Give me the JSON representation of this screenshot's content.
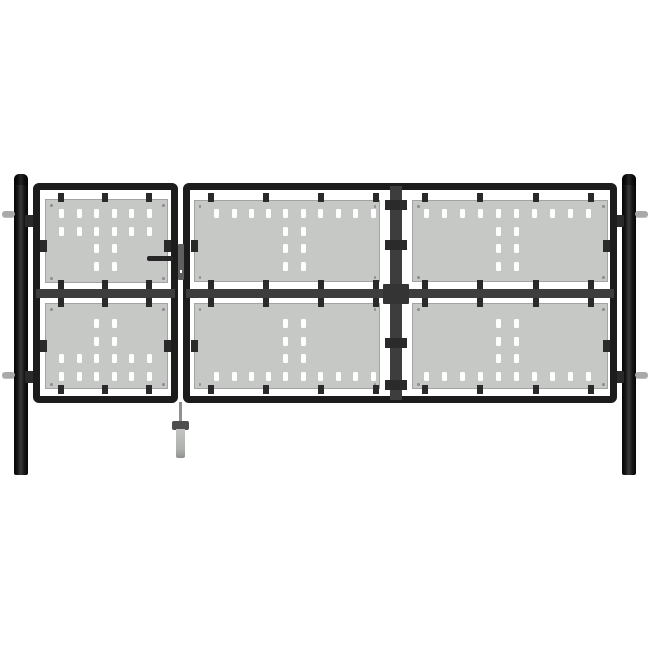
{
  "scene": {
    "type": "product-image",
    "subject": "black steel single-and-double garden gate with grey perforated panels, two round posts, handle and drop bolt",
    "background": "#ffffff"
  },
  "colors": {
    "bg": "#ffffff",
    "frame": "#1c1c1c",
    "rail": "#3d3d3d",
    "panel": "#c6c8c6",
    "slot": "#ffffff",
    "clamp": "#2a2a2a",
    "hinge": "#a7aaa7",
    "lock": "#5f5f5f",
    "handle": "#262626",
    "boltcap": "#4e4e4e"
  },
  "gate": {
    "panels": [
      {
        "id": "pedestrian-top-panel",
        "x": 45,
        "y": 199,
        "w": 123,
        "h": 84,
        "rows": [
          {
            "y": 212.5,
            "xs": [
              60.5,
              78,
              95.5,
              113,
              130.5,
              148
            ]
          },
          {
            "y": 230,
            "xs": [
              60.5,
              78,
              95.5,
              113,
              130.5,
              148
            ]
          },
          {
            "y": 247.5,
            "xs": [
              95.5,
              113
            ]
          },
          {
            "y": 265,
            "xs": [
              95.5,
              113
            ]
          }
        ]
      },
      {
        "id": "pedestrian-bottom-panel",
        "x": 45,
        "y": 303,
        "w": 123,
        "h": 86,
        "rows": [
          {
            "y": 322.5,
            "xs": [
              95.5,
              113
            ]
          },
          {
            "y": 340,
            "xs": [
              95.5,
              113
            ]
          },
          {
            "y": 357.5,
            "xs": [
              60.5,
              78,
              95.5,
              113,
              130.5,
              148
            ]
          },
          {
            "y": 375,
            "xs": [
              60.5,
              78,
              95.5,
              113,
              130.5,
              148
            ]
          }
        ]
      },
      {
        "id": "double-gate-top-left-panel",
        "x": 193.5,
        "y": 200,
        "w": 186,
        "h": 82,
        "rows": [
          {
            "y": 212.5,
            "xs": [
              215.5,
              233,
              250.5,
              267.5,
              284.5,
              302,
              319.5,
              337,
              354.5,
              372
            ]
          },
          {
            "y": 230,
            "xs": [
              284.5,
              302
            ]
          },
          {
            "y": 247.5,
            "xs": [
              284.5,
              302
            ]
          },
          {
            "y": 265,
            "xs": [
              284.5,
              302
            ]
          }
        ]
      },
      {
        "id": "double-gate-top-right-panel",
        "x": 412,
        "y": 200,
        "w": 196,
        "h": 82,
        "rows": [
          {
            "y": 212.5,
            "xs": [
              425.5,
              443.5,
              461.5,
              479.5,
              497.5,
              515.5,
              533.5,
              551.5,
              569.5,
              587
            ]
          },
          {
            "y": 230,
            "xs": [
              497.5,
              515.5
            ]
          },
          {
            "y": 247.5,
            "xs": [
              497.5,
              515.5
            ]
          },
          {
            "y": 265,
            "xs": [
              497.5,
              515.5
            ]
          }
        ]
      },
      {
        "id": "double-gate-bottom-left-panel",
        "x": 193.5,
        "y": 303,
        "w": 186,
        "h": 86,
        "rows": [
          {
            "y": 322.5,
            "xs": [
              284.5,
              302
            ]
          },
          {
            "y": 340,
            "xs": [
              284.5,
              302
            ]
          },
          {
            "y": 357.5,
            "xs": [
              284.5,
              302
            ]
          },
          {
            "y": 375,
            "xs": [
              215.5,
              233,
              250.5,
              267.5,
              284.5,
              302,
              319.5,
              337,
              354.5,
              372
            ]
          }
        ]
      },
      {
        "id": "double-gate-bottom-right-panel",
        "x": 412,
        "y": 303,
        "w": 196,
        "h": 86,
        "rows": [
          {
            "y": 322.5,
            "xs": [
              497.5,
              515.5
            ]
          },
          {
            "y": 340,
            "xs": [
              497.5,
              515.5
            ]
          },
          {
            "y": 357.5,
            "xs": [
              497.5,
              515.5
            ]
          },
          {
            "y": 375,
            "xs": [
              425.5,
              443.5,
              461.5,
              479.5,
              497.5,
              515.5,
              533.5,
              551.5,
              569.5,
              587
            ]
          }
        ]
      }
    ],
    "rail_clamps": [
      {
        "xs": [
          61,
          105,
          149
        ],
        "ys": [
          193,
          280,
          298,
          385
        ]
      },
      {
        "xs": [
          211,
          266,
          321,
          376
        ],
        "ys": [
          193,
          280,
          298,
          385
        ]
      },
      {
        "xs": [
          425,
          480,
          536,
          591
        ],
        "ys": [
          193,
          280,
          298,
          385
        ]
      }
    ],
    "side_clamps": [
      {
        "x": 40,
        "y": 240
      },
      {
        "x": 40,
        "y": 340
      },
      {
        "x": 164,
        "y": 240
      },
      {
        "x": 164,
        "y": 340
      },
      {
        "x": 190.5,
        "y": 240
      },
      {
        "x": 190.5,
        "y": 340
      },
      {
        "x": 603,
        "y": 240
      },
      {
        "x": 603,
        "y": 340
      }
    ],
    "divider_clamps": [
      200,
      240,
      338,
      380
    ]
  }
}
